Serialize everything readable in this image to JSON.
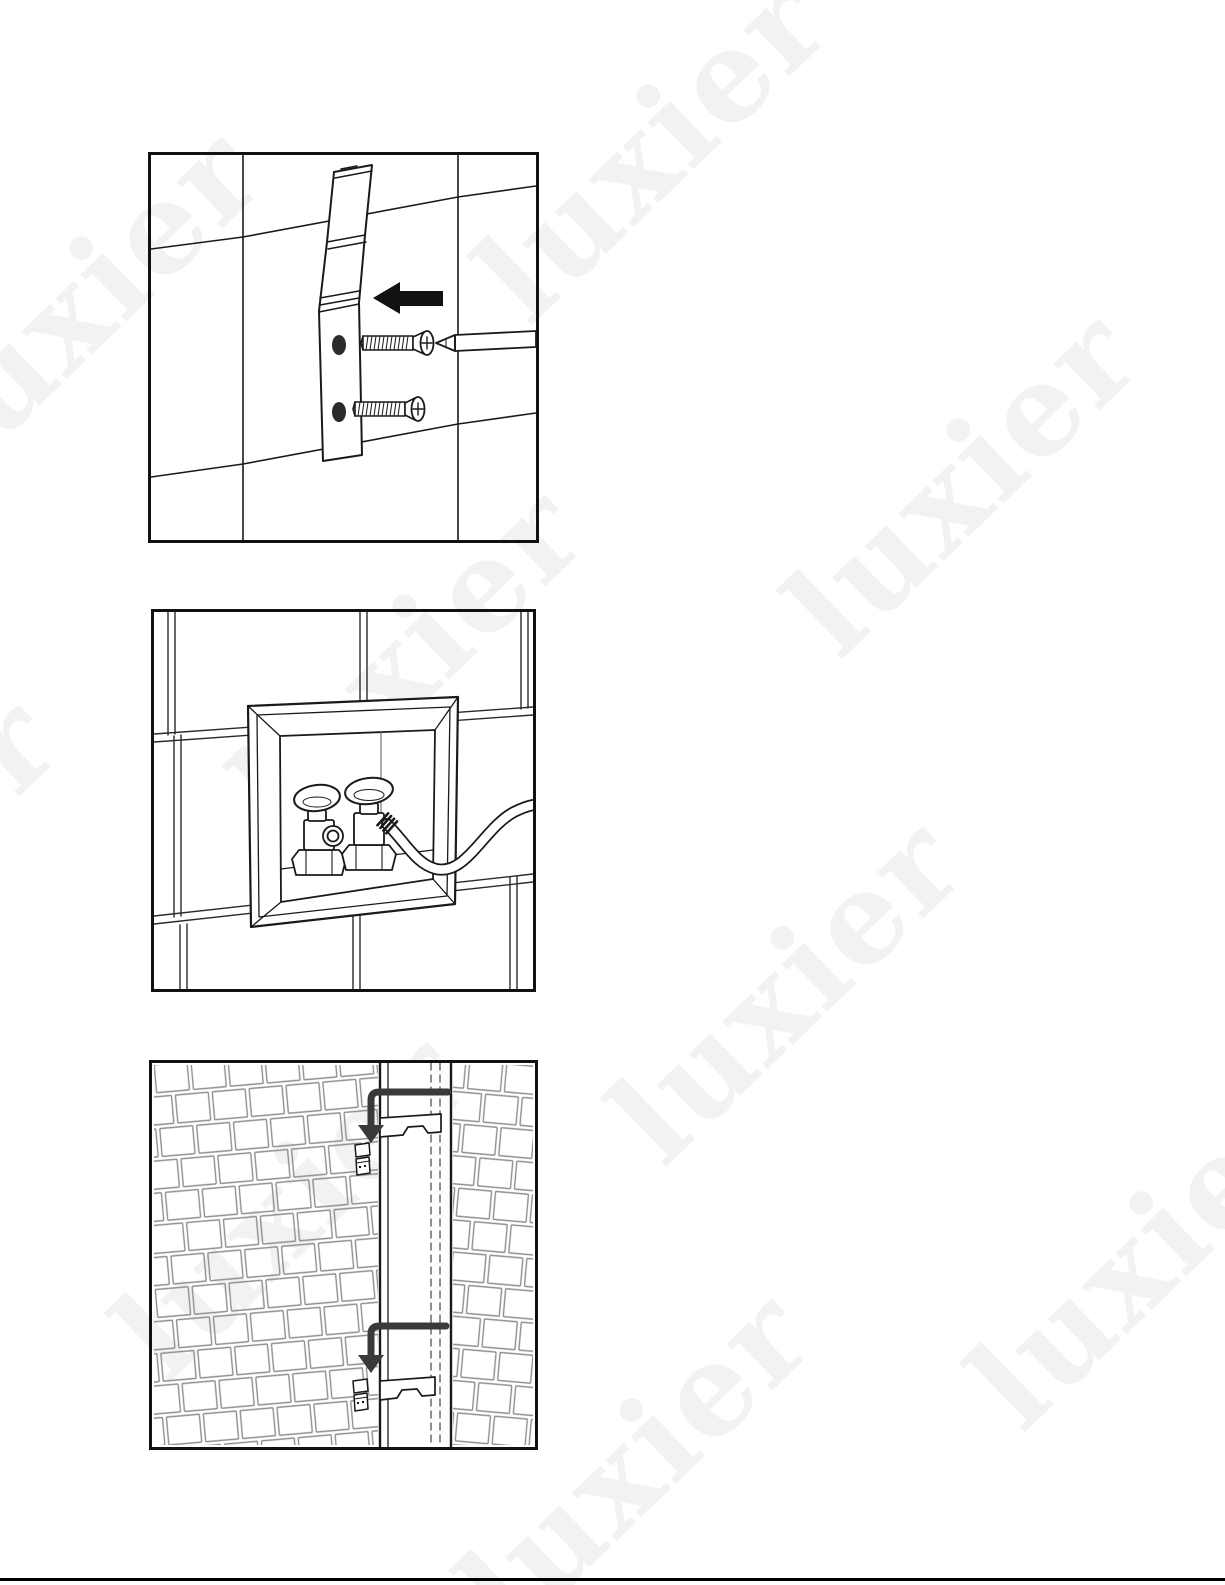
{
  "page": {
    "width": 1225,
    "height": 1585,
    "background": "#ffffff",
    "footer_rule_color": "#000000"
  },
  "watermark": {
    "text": "luxier",
    "color": "#f2f2f2",
    "rotation_deg": -44,
    "font_size_px": 126,
    "instances": [
      {
        "x": 85,
        "y": 300
      },
      {
        "x": 652,
        "y": 148
      },
      {
        "x": 962,
        "y": 482
      },
      {
        "x": 408,
        "y": 658
      },
      {
        "x": -118,
        "y": 868
      },
      {
        "x": 786,
        "y": 990
      },
      {
        "x": 1145,
        "y": 1255
      },
      {
        "x": 290,
        "y": 1205
      },
      {
        "x": 635,
        "y": 1462
      }
    ]
  },
  "line_art": {
    "ink": "#1a1a1a",
    "tile_grout": "#2a2a2a",
    "brick_grout": "#8f8f8f",
    "arrow_black": "#111111",
    "arrow_dark_gray": "#3a3a3a"
  },
  "figures": [
    {
      "id": "fig-1",
      "alt": "Step illustration: mounting bracket fastened to a tiled wall with two screws driven by a Phillips screwdriver, arrow pointing left toward the bracket"
    },
    {
      "id": "fig-2",
      "alt": "Step illustration: recessed in-wall supply box in a subway-tile wall containing two shut-off valves, with a supply hose connected to the right valve"
    },
    {
      "id": "fig-3",
      "alt": "Step illustration: two bent arrows showing small clips sliding down into the vertical mounting rail channel on a brick-tiled wall"
    }
  ]
}
